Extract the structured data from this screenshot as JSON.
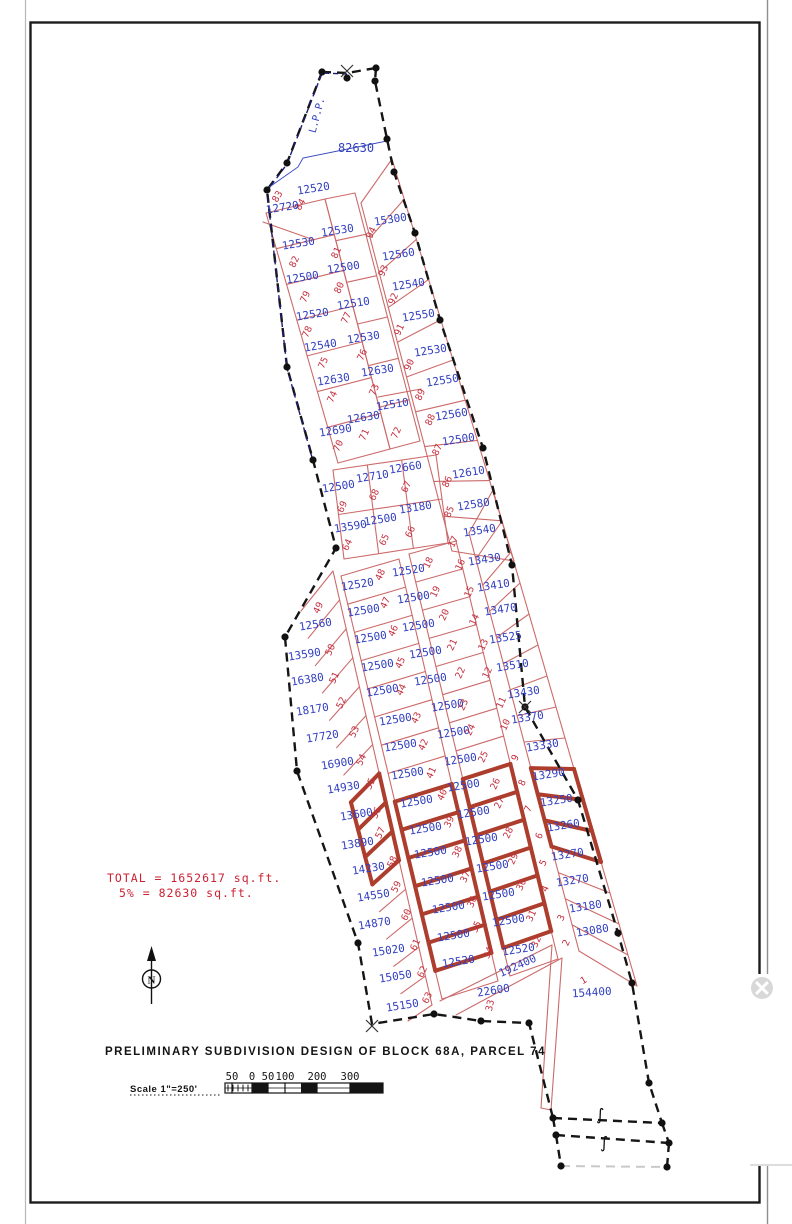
{
  "title": "PRELIMINARY SUBDIVISION DESIGN OF BLOCK 68A, PARCEL 74",
  "totals": {
    "line1": "TOTAL = 1652617 sq.ft.",
    "line2": "5% = 82630 sq.ft."
  },
  "scale": {
    "label": "Scale 1\"=250'",
    "ticks": [
      "50",
      "0",
      "50",
      "100",
      "200",
      "300"
    ]
  },
  "north": {
    "letter": "N"
  },
  "colors": {
    "area_blue": "#3340c0",
    "lot_red": "#c4303f",
    "line_red": "#cc6a6a",
    "bold_block": "#ad3d2d",
    "boundary": "#151515",
    "lpp_navy": "#1b1b70"
  },
  "annotations": [
    {
      "text": "82630",
      "x": 356,
      "y": 152,
      "rot": 0,
      "size": 12,
      "color": "#3340c0",
      "name": "open-space-area-label"
    },
    {
      "text": "L.P.P.",
      "x": 320,
      "y": 116,
      "rot": -75,
      "size": 10,
      "color": "#3340c0",
      "name": "lpp-label"
    },
    {
      "text": "192400",
      "x": 519,
      "y": 969,
      "rot": -24,
      "size": 11,
      "color": "#3340c0",
      "name": "road-area-label"
    }
  ],
  "close_widget": {
    "icon": "x-circle"
  },
  "lots": [
    {
      "n": "84",
      "a": "12520",
      "ax": 314,
      "ay": 192,
      "nx": 303,
      "ny": 206,
      "nr": -60
    },
    {
      "n": "83",
      "a": "12720",
      "ax": 283,
      "ay": 211,
      "nx": 280,
      "ny": 198,
      "nr": -60
    },
    {
      "n": "82",
      "a": "12530",
      "ax": 299,
      "ay": 247,
      "nx": 297,
      "ny": 263
    },
    {
      "n": "79",
      "a": "12500",
      "ax": 303,
      "ay": 281,
      "nx": 308,
      "ny": 298
    },
    {
      "n": "78",
      "a": "12520",
      "ax": 313,
      "ay": 318,
      "nx": 310,
      "ny": 333
    },
    {
      "n": "75",
      "a": "12540",
      "ax": 321,
      "ay": 349,
      "nx": 326,
      "ny": 364
    },
    {
      "n": "74",
      "a": "12630",
      "ax": 334,
      "ay": 383,
      "nx": 335,
      "ny": 398
    },
    {
      "n": "70",
      "a": "12690",
      "ax": 336,
      "ay": 434,
      "nx": 341,
      "ny": 447
    },
    {
      "n": "81",
      "a": "12530",
      "ax": 338,
      "ay": 234,
      "nx": 339,
      "ny": 254
    },
    {
      "n": "80",
      "a": "12500",
      "ax": 344,
      "ay": 271,
      "nx": 342,
      "ny": 289
    },
    {
      "n": "77",
      "a": "12510",
      "ax": 354,
      "ay": 307,
      "nx": 349,
      "ny": 319
    },
    {
      "n": "76",
      "a": "12530",
      "ax": 364,
      "ay": 341,
      "nx": 365,
      "ny": 356
    },
    {
      "n": "73",
      "a": "12630",
      "ax": 378,
      "ay": 374,
      "nx": 377,
      "ny": 391
    },
    {
      "n": "71",
      "a": "12630",
      "ax": 364,
      "ay": 421,
      "nx": 367,
      "ny": 436
    },
    {
      "n": "72",
      "a": "12510",
      "ax": 393,
      "ay": 408,
      "nx": 399,
      "ny": 434
    },
    {
      "n": "69",
      "a": "12500",
      "ax": 339,
      "ay": 490,
      "nx": 345,
      "ny": 508
    },
    {
      "n": "68",
      "a": "12710",
      "ax": 373,
      "ay": 480,
      "nx": 377,
      "ny": 496
    },
    {
      "n": "67",
      "a": "12660",
      "ax": 406,
      "ay": 471,
      "nx": 409,
      "ny": 488
    },
    {
      "n": "64",
      "a": "13590",
      "ax": 351,
      "ay": 530,
      "nx": 350,
      "ny": 546
    },
    {
      "n": "65",
      "a": "12500",
      "ax": 381,
      "ay": 523,
      "nx": 387,
      "ny": 541
    },
    {
      "n": "66",
      "a": "13180",
      "ax": 416,
      "ay": 511,
      "nx": 413,
      "ny": 533
    },
    {
      "n": "94",
      "a": "15300",
      "ax": 391,
      "ay": 223,
      "nx": 374,
      "ny": 234
    },
    {
      "n": "93",
      "a": "12560",
      "ax": 399,
      "ay": 258,
      "nx": 386,
      "ny": 272
    },
    {
      "n": "92",
      "a": "12540",
      "ax": 409,
      "ay": 288,
      "nx": 396,
      "ny": 300
    },
    {
      "n": "91",
      "a": "12550",
      "ax": 419,
      "ay": 319,
      "nx": 402,
      "ny": 331
    },
    {
      "n": "90",
      "a": "12530",
      "ax": 431,
      "ay": 354,
      "nx": 412,
      "ny": 366
    },
    {
      "n": "89",
      "a": "12550",
      "ax": 443,
      "ay": 384,
      "nx": 423,
      "ny": 396
    },
    {
      "n": "88",
      "a": "12560",
      "ax": 452,
      "ay": 418,
      "nx": 433,
      "ny": 421
    },
    {
      "n": "87",
      "a": "12500",
      "ax": 459,
      "ay": 443,
      "nx": 440,
      "ny": 451
    },
    {
      "n": "86",
      "a": "12610",
      "ax": 469,
      "ay": 476,
      "nx": 450,
      "ny": 483
    },
    {
      "n": "85",
      "a": "12580",
      "ax": 474,
      "ay": 508,
      "nx": 452,
      "ny": 513
    },
    {
      "n": "49",
      "a": "12560",
      "ax": 316,
      "ay": 628,
      "nx": 321,
      "ny": 609
    },
    {
      "n": "50",
      "a": "13590",
      "ax": 305,
      "ay": 658,
      "nx": 333,
      "ny": 651
    },
    {
      "n": "51",
      "a": "16380",
      "ax": 308,
      "ay": 683,
      "nx": 337,
      "ny": 679
    },
    {
      "n": "52",
      "a": "18170",
      "ax": 313,
      "ay": 713,
      "nx": 344,
      "ny": 704
    },
    {
      "n": "53",
      "a": "17720",
      "ax": 323,
      "ay": 740,
      "nx": 357,
      "ny": 733
    },
    {
      "n": "54",
      "a": "16900",
      "ax": 338,
      "ay": 767,
      "nx": 364,
      "ny": 761
    },
    {
      "n": "55",
      "a": "14930",
      "ax": 344,
      "ay": 791,
      "nx": 373,
      "ny": 785
    },
    {
      "n": "56",
      "a": "13600",
      "ax": 357,
      "ay": 818,
      "nx": 379,
      "ny": 814,
      "bold": true
    },
    {
      "n": "57",
      "a": "13890",
      "ax": 358,
      "ay": 847,
      "nx": 383,
      "ny": 834,
      "bold": true
    },
    {
      "n": "58",
      "a": "14230",
      "ax": 369,
      "ay": 872,
      "nx": 395,
      "ny": 863,
      "bold": true
    },
    {
      "n": "59",
      "a": "14550",
      "ax": 374,
      "ay": 899,
      "nx": 399,
      "ny": 888
    },
    {
      "n": "60",
      "a": "14870",
      "ax": 375,
      "ay": 927,
      "nx": 409,
      "ny": 916
    },
    {
      "n": "61",
      "a": "15020",
      "ax": 389,
      "ay": 954,
      "nx": 418,
      "ny": 946
    },
    {
      "n": "62",
      "a": "15050",
      "ax": 396,
      "ay": 980,
      "nx": 425,
      "ny": 973
    },
    {
      "n": "63",
      "a": "15150",
      "ax": 403,
      "ay": 1009,
      "nx": 430,
      "ny": 999
    },
    {
      "n": "48",
      "a": "12520",
      "ax": 358,
      "ay": 588,
      "nx": 383,
      "ny": 576
    },
    {
      "n": "47",
      "a": "12500",
      "ax": 364,
      "ay": 614,
      "nx": 388,
      "ny": 604
    },
    {
      "n": "46",
      "a": "12500",
      "ax": 371,
      "ay": 641,
      "nx": 396,
      "ny": 632
    },
    {
      "n": "45",
      "a": "12500",
      "ax": 378,
      "ay": 669,
      "nx": 403,
      "ny": 664
    },
    {
      "n": "44",
      "a": "12500",
      "ax": 383,
      "ay": 694,
      "nx": 404,
      "ny": 691
    },
    {
      "n": "43",
      "a": "12500",
      "ax": 396,
      "ay": 723,
      "nx": 419,
      "ny": 719
    },
    {
      "n": "42",
      "a": "12500",
      "ax": 401,
      "ay": 749,
      "nx": 426,
      "ny": 746
    },
    {
      "n": "41",
      "a": "12500",
      "ax": 408,
      "ay": 777,
      "nx": 434,
      "ny": 774
    },
    {
      "n": "40",
      "a": "12500",
      "ax": 417,
      "ay": 805,
      "nx": 445,
      "ny": 796,
      "bold": true
    },
    {
      "n": "39",
      "a": "12500",
      "ax": 426,
      "ay": 832,
      "nx": 452,
      "ny": 823,
      "bold": true
    },
    {
      "n": "38",
      "a": "12500",
      "ax": 431,
      "ay": 856,
      "nx": 460,
      "ny": 853,
      "bold": true
    },
    {
      "n": "37",
      "a": "12500",
      "ax": 438,
      "ay": 884,
      "nx": 468,
      "ny": 878,
      "bold": true
    },
    {
      "n": "36",
      "a": "12500",
      "ax": 449,
      "ay": 911,
      "nx": 475,
      "ny": 903,
      "bold": true
    },
    {
      "n": "35",
      "a": "12500",
      "ax": 454,
      "ay": 939,
      "nx": 479,
      "ny": 928,
      "bold": true
    },
    {
      "n": "34",
      "a": "12520",
      "ax": 459,
      "ay": 965,
      "nx": 491,
      "ny": 954
    },
    {
      "n": "18",
      "a": "12520",
      "ax": 409,
      "ay": 574,
      "nx": 431,
      "ny": 564
    },
    {
      "n": "19",
      "a": "12500",
      "ax": 414,
      "ay": 601,
      "nx": 438,
      "ny": 593
    },
    {
      "n": "20",
      "a": "12500",
      "ax": 419,
      "ay": 629,
      "nx": 447,
      "ny": 616
    },
    {
      "n": "21",
      "a": "12500",
      "ax": 426,
      "ay": 656,
      "nx": 455,
      "ny": 646
    },
    {
      "n": "22",
      "a": "12500",
      "ax": 431,
      "ay": 683,
      "nx": 463,
      "ny": 674
    },
    {
      "n": "23",
      "a": "12500",
      "ax": 448,
      "ay": 709,
      "nx": 466,
      "ny": 706
    },
    {
      "n": "24",
      "a": "12500",
      "ax": 454,
      "ay": 736,
      "nx": 473,
      "ny": 731
    },
    {
      "n": "25",
      "a": "12500",
      "ax": 461,
      "ay": 763,
      "nx": 486,
      "ny": 758
    },
    {
      "n": "26",
      "a": "12500",
      "ax": 464,
      "ay": 789,
      "nx": 498,
      "ny": 785,
      "bold": true
    },
    {
      "n": "27",
      "a": "12500",
      "ax": 474,
      "ay": 816,
      "nx": 502,
      "ny": 804,
      "bold": true
    },
    {
      "n": "28",
      "a": "12500",
      "ax": 482,
      "ay": 843,
      "nx": 511,
      "ny": 834,
      "bold": true
    },
    {
      "n": "29",
      "a": "12500",
      "ax": 493,
      "ay": 870,
      "nx": 516,
      "ny": 860,
      "bold": true
    },
    {
      "n": "30",
      "a": "12500",
      "ax": 499,
      "ay": 898,
      "nx": 524,
      "ny": 886,
      "bold": true
    },
    {
      "n": "31",
      "a": "12500",
      "ax": 509,
      "ay": 924,
      "nx": 534,
      "ny": 917,
      "bold": true
    },
    {
      "n": "32",
      "a": "12520",
      "ax": 519,
      "ay": 953,
      "nx": 539,
      "ny": 943
    },
    {
      "n": "17",
      "a": "13540",
      "ax": 480,
      "ay": 534,
      "nx": 456,
      "ny": 543
    },
    {
      "n": "16",
      "a": "13430",
      "ax": 485,
      "ay": 563,
      "nx": 463,
      "ny": 566
    },
    {
      "n": "15",
      "a": "13410",
      "ax": 494,
      "ay": 589,
      "nx": 472,
      "ny": 593
    },
    {
      "n": "14",
      "a": "13470",
      "ax": 501,
      "ay": 613,
      "nx": 477,
      "ny": 621
    },
    {
      "n": "13",
      "a": "13525",
      "ax": 506,
      "ay": 641,
      "nx": 486,
      "ny": 646
    },
    {
      "n": "12",
      "a": "13510",
      "ax": 513,
      "ay": 669,
      "nx": 490,
      "ny": 674
    },
    {
      "n": "11",
      "a": "13430",
      "ax": 524,
      "ay": 696,
      "nx": 504,
      "ny": 704
    },
    {
      "n": "10",
      "a": "13370",
      "ax": 528,
      "ay": 721,
      "nx": 508,
      "ny": 726
    },
    {
      "n": "9",
      "a": "13330",
      "ax": 543,
      "ay": 749,
      "nx": 518,
      "ny": 759
    },
    {
      "n": "8",
      "a": "13290",
      "ax": 549,
      "ay": 778,
      "nx": 525,
      "ny": 784,
      "bold": true
    },
    {
      "n": "7",
      "a": "13250",
      "ax": 557,
      "ay": 804,
      "nx": 531,
      "ny": 810,
      "bold": true
    },
    {
      "n": "6",
      "a": "13260",
      "ax": 564,
      "ay": 829,
      "nx": 542,
      "ny": 837,
      "bold": true
    },
    {
      "n": "5",
      "a": "13270",
      "ax": 568,
      "ay": 858,
      "nx": 546,
      "ny": 864
    },
    {
      "n": "4",
      "a": "13270",
      "ax": 573,
      "ay": 884,
      "nx": 548,
      "ny": 890
    },
    {
      "n": "3",
      "a": "13180",
      "ax": 586,
      "ay": 910,
      "nx": 564,
      "ny": 919
    },
    {
      "n": "2",
      "a": "13080",
      "ax": 593,
      "ay": 934,
      "nx": 569,
      "ny": 944
    },
    {
      "n": "33",
      "a": "22600",
      "ax": 494,
      "ay": 994,
      "nx": 493,
      "ny": 1006,
      "nr": -78
    },
    {
      "n": "1",
      "a": "154400",
      "ax": 592,
      "ay": 996,
      "nx": 585,
      "ny": 983,
      "ar": -4,
      "nr": -30
    }
  ]
}
